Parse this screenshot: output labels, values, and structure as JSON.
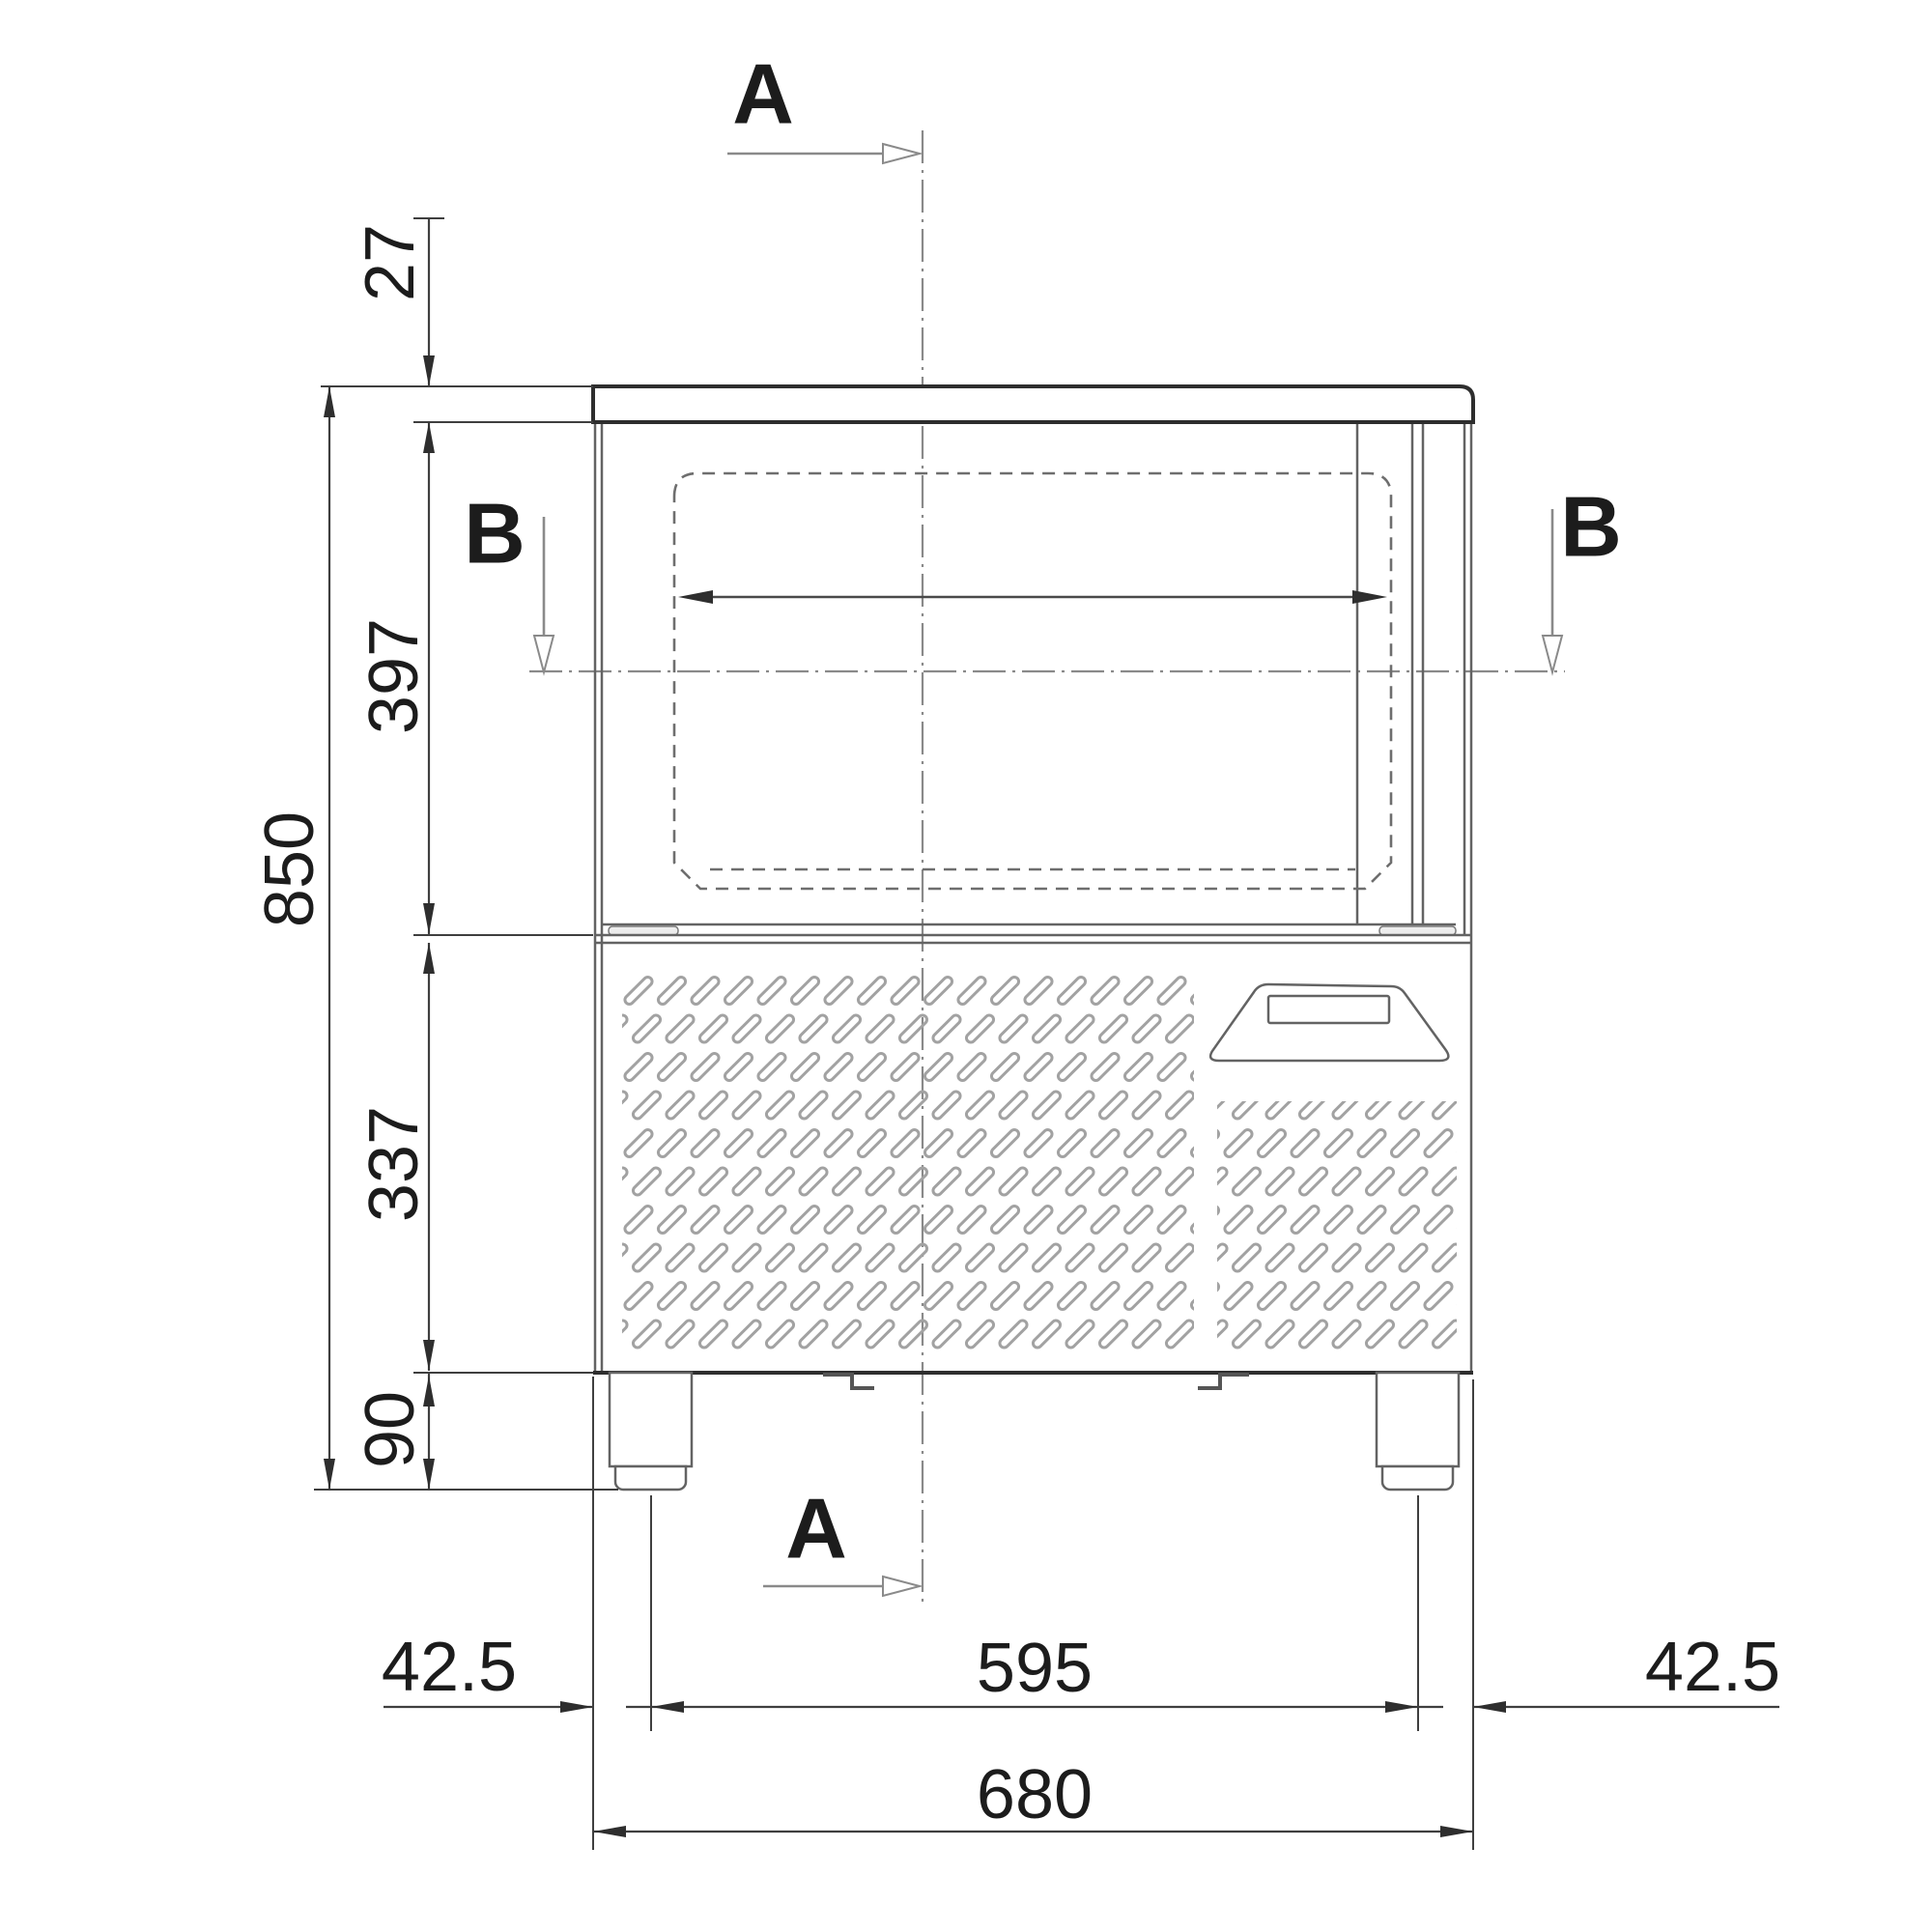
{
  "sections": {
    "top_label": "A",
    "bottom_label": "A",
    "left_label": "B",
    "right_label": "B"
  },
  "dimensions": {
    "worktop_thickness": "27",
    "overall_height": "850",
    "upper_section_height": "397",
    "lower_section_height": "337",
    "leg_height": "90",
    "left_leg_offset": "42.5",
    "leg_center_distance": "595",
    "right_leg_offset": "42.5",
    "overall_width": "680"
  },
  "colors": {
    "background": "#ffffff",
    "outline_gray": "#636363",
    "dimension_line": "#3f3f3f",
    "text": "#1c1c1c",
    "centerline": "#8a8a8a",
    "vent_slot": "#a2a2a2"
  }
}
